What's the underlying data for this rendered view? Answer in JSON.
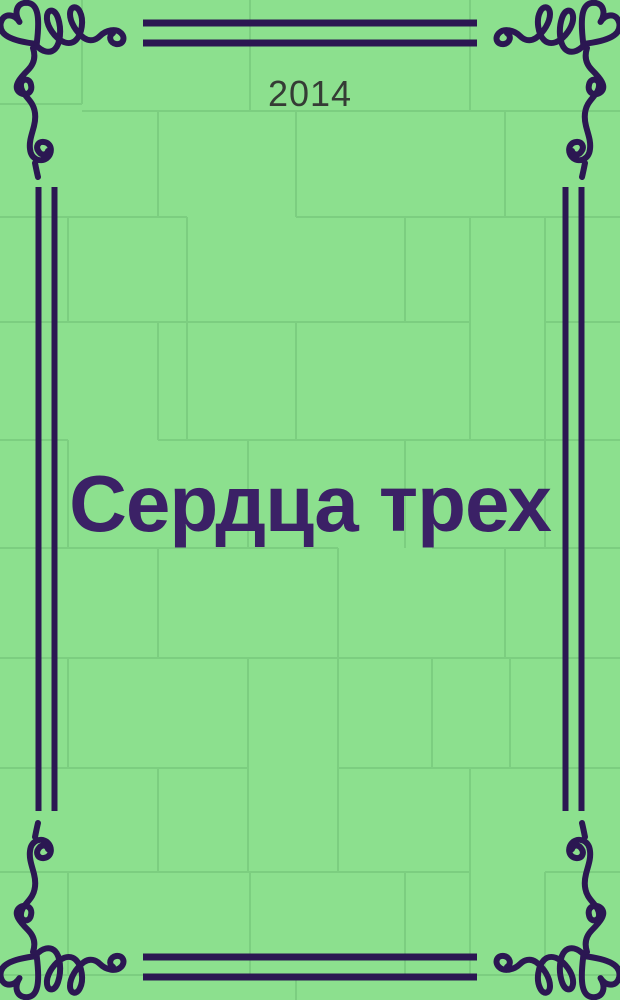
{
  "cover": {
    "year": "2014",
    "title": "Сердца трех"
  },
  "icons": {
    "corner_flourish": "heart-swirl-flourish",
    "border": "double-rule-frame"
  },
  "colors": {
    "background": "#8ce08e",
    "brick_line": "#7cce80",
    "ornament": "#2b1752",
    "title_text": "#3b2166",
    "year_text": "#353c35"
  }
}
